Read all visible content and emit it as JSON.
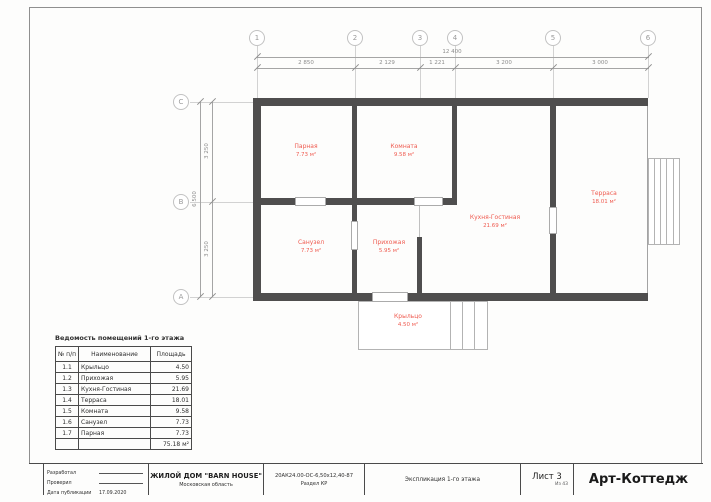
{
  "grid": {
    "top": [
      {
        "label": "1"
      },
      {
        "label": "2"
      },
      {
        "label": "3"
      },
      {
        "label": "4"
      },
      {
        "label": "5"
      },
      {
        "label": "6"
      }
    ],
    "left": [
      {
        "label": "C"
      },
      {
        "label": "B"
      },
      {
        "label": "A"
      }
    ],
    "dims_top": {
      "total": "12 400",
      "segments": [
        "2 850",
        "2 129",
        "1 221",
        "3 200",
        "3 000"
      ]
    },
    "dims_left": {
      "total": "6 500",
      "segments": [
        "3 250",
        "3 250"
      ]
    }
  },
  "rooms": [
    {
      "name": "Парная",
      "area": "7.73 м²"
    },
    {
      "name": "Комната",
      "area": "9.58 м²"
    },
    {
      "name": "Санузел",
      "area": "7.73 м²"
    },
    {
      "name": "Прихожая",
      "area": "5.95 м²"
    },
    {
      "name": "Кухня-Гостиная",
      "area": "21.69 м²"
    },
    {
      "name": "Терраса",
      "area": "18.01 м²"
    },
    {
      "name": "Крыльцо",
      "area": "4.50 м²"
    }
  ],
  "schedule": {
    "title": "Ведомость помещений 1-го этажа",
    "headers": [
      "№ п/п",
      "Наименование",
      "Площадь"
    ],
    "rows": [
      [
        "1.1",
        "Крыльцо",
        "4.50"
      ],
      [
        "1.2",
        "Прихожая",
        "5.95"
      ],
      [
        "1.3",
        "Кухня-Гостиная",
        "21.69"
      ],
      [
        "1.4",
        "Терраса",
        "18.01"
      ],
      [
        "1.5",
        "Комната",
        "9.58"
      ],
      [
        "1.6",
        "Санузел",
        "7.73"
      ],
      [
        "1.7",
        "Парная",
        "7.73"
      ]
    ],
    "total": "75.18 м²"
  },
  "titleblock": {
    "developed_label": "Разработал",
    "checked_label": "Проверил",
    "date_label": "Дата публикации",
    "date_value": "17.09.2020",
    "project_title": "ЖИЛОЙ ДОМ \"BARN HOUSE\"",
    "region": "Московская область",
    "code": "20АК24.00-ОС-6,50х12,40-87",
    "section": "Раздел КР",
    "sheet_title": "Экспликация 1-го этажа",
    "sheet_label": "Лист 3",
    "sheet_of": "Из 43",
    "brand": "Арт-Коттедж"
  }
}
